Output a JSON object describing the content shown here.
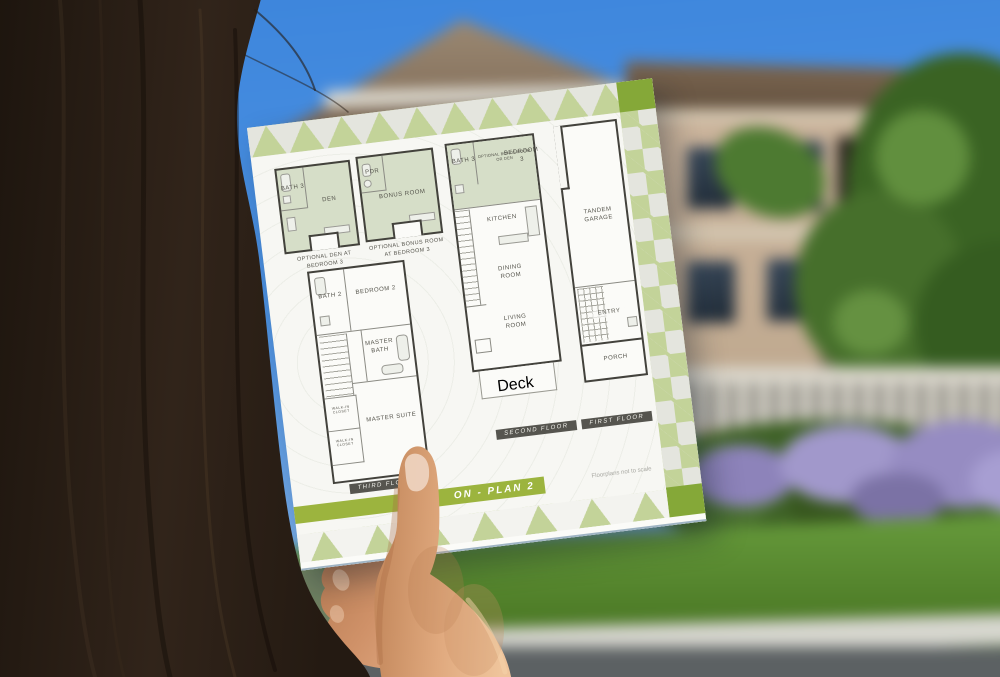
{
  "brochure": {
    "banner_label": "ON - Plan 2",
    "disclaimer": "Floorplans not to scale",
    "colors": {
      "accent_green": "#85a838",
      "banner_green": "#9cb43e",
      "light_green": "#c3d399",
      "band_background": "#e4e5de",
      "paper": "#f7f7f3",
      "plan_line": "#43423c",
      "optional_room_fill": "#d6dec8"
    },
    "plans": {
      "option_den": {
        "caption": "Optional Den at Bedroom 3",
        "rooms": {
          "bath": "Bath 3",
          "den": "Den"
        }
      },
      "option_bonus": {
        "caption": "Optional Bonus Room at Bedroom 3",
        "rooms": {
          "pdr": "Pdr",
          "bonus": "Bonus Room"
        }
      },
      "second_floor": {
        "label": "Second Floor",
        "rooms": {
          "bath3": "Bath 3",
          "bedroom3": "Bedroom 3",
          "bedroom3_note": "Optional Bonus Room or Den",
          "kitchen": "Kitchen",
          "dining": "Dining Room",
          "living": "Living Room",
          "deck": "Deck"
        }
      },
      "first_floor": {
        "label": "First Floor",
        "rooms": {
          "garage": "Tandem Garage",
          "entry": "Entry",
          "porch": "Porch"
        }
      },
      "third_floor": {
        "label": "Third Floor",
        "rooms": {
          "bath2": "Bath 2",
          "bedroom2": "Bedroom 2",
          "master_bath": "Master Bath",
          "master_suite": "Master Suite",
          "closet1": "Walk-in Closet",
          "closet2": "Walk-in Closet"
        }
      }
    }
  },
  "photo_colors": {
    "sky": "#4d92e2",
    "house_wall": "#c4ae94",
    "roof": "#7a6550",
    "tree": "#3f672a",
    "flowers": "#978dc2",
    "grass": "#55842f",
    "street": "#5c6163",
    "hair": "#281d13",
    "skin": "#dda47c"
  }
}
